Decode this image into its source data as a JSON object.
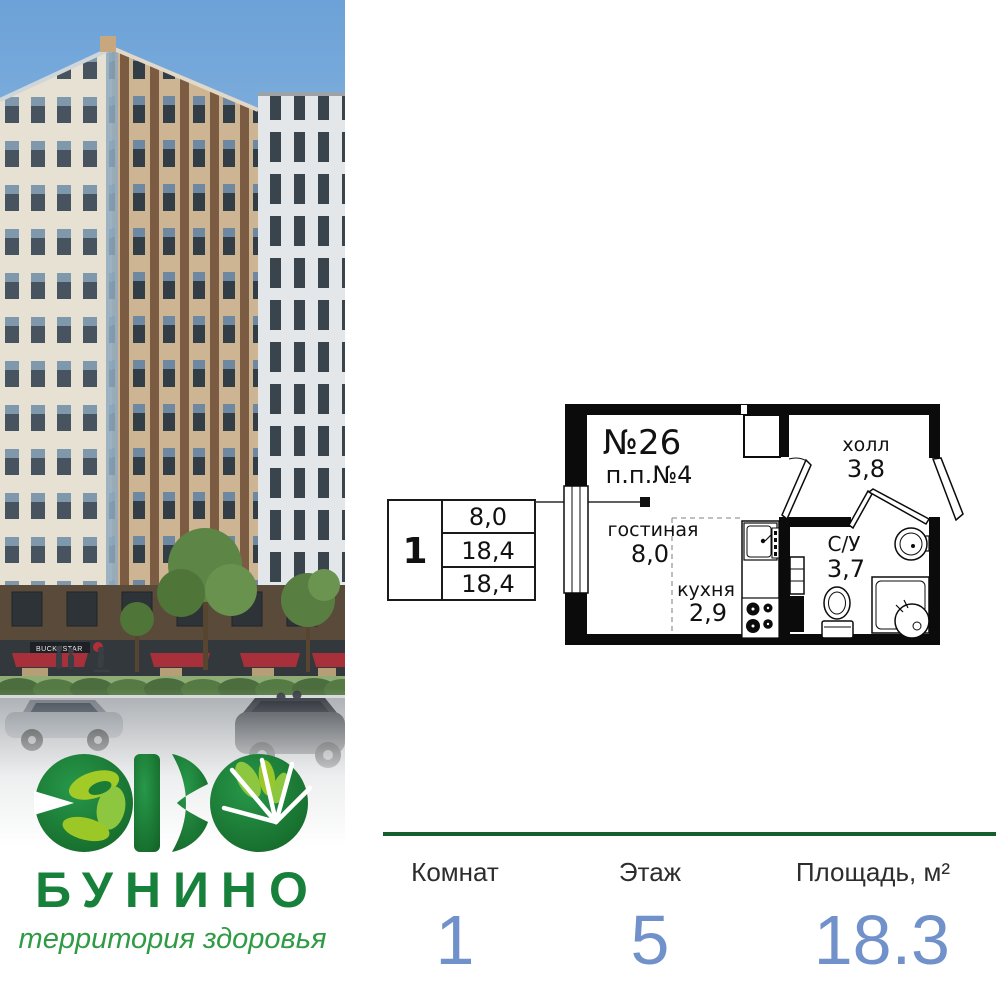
{
  "brand": {
    "logo_word": "БУНИНО",
    "tagline": "территория здоровья"
  },
  "photo": {
    "storefront_sign": "BUCKSSTAR"
  },
  "plan": {
    "apartment_number": "№26",
    "plan_code": "п.п.№4",
    "rooms": {
      "living": {
        "name": "гостиная",
        "area": "8,0"
      },
      "kitchen": {
        "name": "кухня",
        "area": "2,9"
      },
      "hall": {
        "name": "холл",
        "area": "3,8"
      },
      "bathroom": {
        "name": "С/У",
        "area": "3,7"
      }
    },
    "spec_table": {
      "rooms_count": "1",
      "row1": "8,0",
      "row2": "18,4",
      "row3": "18,4"
    }
  },
  "stats": {
    "rooms_label": "Комнат",
    "rooms_value": "1",
    "floor_label": "Этаж",
    "floor_value": "5",
    "area_label": "Площадь, м²",
    "area_value": "18.3"
  },
  "colors": {
    "brand_green_dark": "#1b7c35",
    "brand_green_light": "#8dc63f",
    "accent_blue": "#7191cb",
    "divider_green": "#155f2d"
  }
}
